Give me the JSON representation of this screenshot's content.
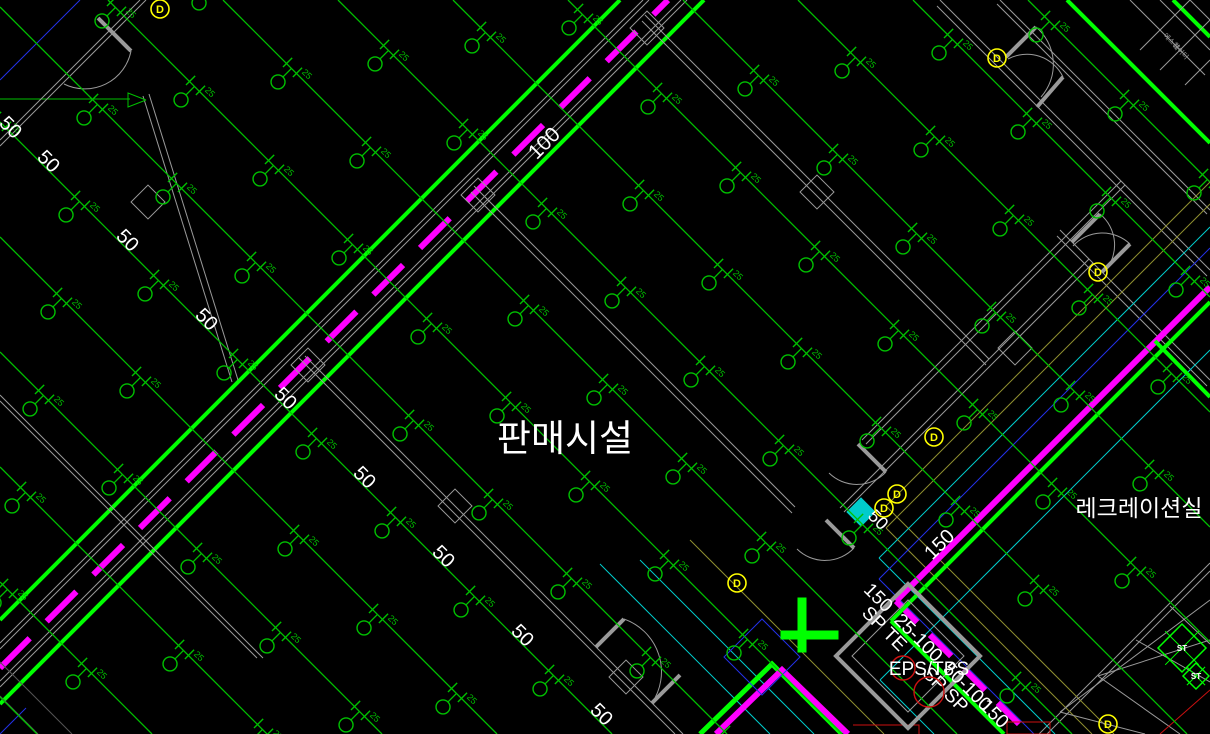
{
  "title_labels": {
    "sales_facility": "판매시설",
    "recreation_room": "레크레이션실",
    "shaft": "EPS/TPS"
  },
  "labels": {
    "head_size": "25",
    "d_marker": "D",
    "st": "ST",
    "stair_text_1": "에스컬",
    "stair_text_2": "레이터"
  },
  "colors": {
    "green": "#00C000",
    "bright": "#00FF00",
    "magenta": "#FF00FF",
    "gray": "#9A9A9A",
    "dimgray": "#555555",
    "blue": "#2332E8",
    "cyan": "#00CCCC",
    "olive": "#8F8F30",
    "yellow": "#FFFF00",
    "red": "#CC1111",
    "white": "#FFFFFF"
  },
  "pipe_labels": [
    {
      "t": "100",
      "x": 549,
      "y": 148,
      "r": -45,
      "s": 21
    },
    {
      "t": "50",
      "x": 6,
      "y": 132,
      "r": 45,
      "s": 20
    },
    {
      "t": "50",
      "x": 44,
      "y": 166,
      "r": 45,
      "s": 20
    },
    {
      "t": "50",
      "x": 123,
      "y": 245,
      "r": 45,
      "s": 20
    },
    {
      "t": "50",
      "x": 202,
      "y": 324,
      "r": 45,
      "s": 20
    },
    {
      "t": "50",
      "x": 281,
      "y": 403,
      "r": 45,
      "s": 20
    },
    {
      "t": "50",
      "x": 360,
      "y": 482,
      "r": 45,
      "s": 20
    },
    {
      "t": "50",
      "x": 439,
      "y": 561,
      "r": 45,
      "s": 20
    },
    {
      "t": "50",
      "x": 518,
      "y": 640,
      "r": 45,
      "s": 20
    },
    {
      "t": "50",
      "x": 597,
      "y": 719,
      "r": 45,
      "s": 20
    },
    {
      "t": "50",
      "x": 874,
      "y": 524,
      "r": 45,
      "s": 18
    },
    {
      "t": "150",
      "x": 944,
      "y": 549,
      "r": -45,
      "s": 20
    },
    {
      "t": "150",
      "x": 874,
      "y": 602,
      "r": 45,
      "s": 19
    },
    {
      "t": "25-100",
      "x": 914,
      "y": 642,
      "r": 45,
      "s": 19
    },
    {
      "t": "SP TE",
      "x": 880,
      "y": 633,
      "r": 45,
      "s": 19
    },
    {
      "t": "SP SP",
      "x": 941,
      "y": 694,
      "r": 45,
      "s": 19
    },
    {
      "t": "50-100",
      "x": 963,
      "y": 691,
      "r": 45,
      "s": 19
    },
    {
      "t": "150",
      "x": 990,
      "y": 718,
      "r": 45,
      "s": 19
    }
  ],
  "drawing": {
    "branches": {
      "c_values": [
        -1028,
        -913,
        -798,
        -683,
        -568,
        -453,
        -338,
        -223,
        -108,
        7,
        122,
        237,
        352,
        467,
        582,
        697
      ],
      "s0": 130,
      "stagger": 79,
      "s_step": 158
    },
    "segments": [
      [
        0,
        620,
        620,
        0,
        "bright",
        4,
        null
      ],
      [
        0,
        643,
        643,
        0,
        "gray",
        1,
        null
      ],
      [
        0,
        649,
        649,
        0,
        "gray",
        1,
        null
      ],
      [
        0,
        668,
        668,
        0,
        "magenta",
        6,
        "42 24"
      ],
      [
        0,
        681,
        681,
        0,
        "gray",
        1,
        null
      ],
      [
        0,
        687,
        687,
        0,
        "gray",
        1,
        null
      ],
      [
        0,
        704,
        704,
        0,
        "bright",
        4,
        null
      ],
      [
        0,
        99,
        130,
        99,
        "green",
        1,
        null
      ],
      [
        80,
        0,
        0,
        80,
        "blue",
        1,
        null
      ],
      [
        26,
        708,
        0,
        734,
        "blue",
        1,
        null
      ],
      [
        0,
        662,
        72,
        734,
        "dimgray",
        1,
        null
      ],
      [
        0,
        696,
        38,
        734,
        "dimgray",
        1,
        null
      ],
      [
        143,
        96,
        232,
        382,
        "gray",
        1,
        null
      ],
      [
        149,
        94,
        238,
        380,
        "gray",
        1,
        null
      ],
      [
        140,
        0,
        0,
        140,
        "gray",
        1,
        null
      ],
      [
        146,
        0,
        0,
        146,
        "gray",
        1,
        null
      ],
      [
        0,
        395,
        263,
        658,
        "gray",
        1,
        null
      ],
      [
        0,
        401,
        257,
        658,
        "gray",
        1,
        null
      ],
      [
        305,
        356,
        683,
        734,
        "gray",
        1,
        null
      ],
      [
        299,
        358,
        675,
        734,
        "gray",
        1,
        null
      ],
      [
        645,
        15,
        989,
        359,
        "gray",
        1,
        null
      ],
      [
        642,
        21,
        986,
        365,
        "gray",
        1,
        null
      ],
      [
        474,
        186,
        795,
        507,
        "gray",
        1,
        null
      ],
      [
        471,
        192,
        792,
        513,
        "gray",
        1,
        null
      ],
      [
        940,
        0,
        1210,
        270,
        "gray",
        1,
        null
      ],
      [
        937,
        6,
        1207,
        276,
        "gray",
        1,
        null
      ],
      [
        1060,
        230,
        1210,
        380,
        "gray",
        1,
        null
      ],
      [
        1057,
        236,
        1207,
        386,
        "gray",
        1,
        null
      ],
      [
        1121,
        181,
        862,
        440,
        "gray",
        1,
        null
      ],
      [
        1125,
        185,
        866,
        444,
        "gray",
        1,
        null
      ],
      [
        1089,
        259,
        840,
        508,
        "gray",
        1,
        null
      ],
      [
        1093,
        263,
        844,
        512,
        "gray",
        1,
        null
      ],
      [
        1210,
        563,
        1039,
        734,
        "gray",
        1,
        null
      ],
      [
        1210,
        571,
        1047,
        734,
        "gray",
        1,
        null
      ],
      [
        1067,
        0,
        1210,
        143,
        "bright",
        4,
        null
      ],
      [
        1173,
        0,
        1210,
        37,
        "bright",
        4,
        null
      ],
      [
        1000,
        0,
        1210,
        210,
        "gray",
        1,
        null
      ],
      [
        997,
        4,
        1207,
        214,
        "gray",
        1,
        null
      ],
      [
        1130,
        0,
        1205,
        75,
        "gray",
        1,
        null
      ],
      [
        1160,
        0,
        1210,
        50,
        "gray",
        1,
        null
      ],
      [
        1190,
        0,
        1210,
        20,
        "gray",
        1,
        null
      ],
      [
        1190,
        0,
        1140,
        50,
        "gray",
        1,
        null
      ],
      [
        1210,
        20,
        1160,
        70,
        "gray",
        1,
        null
      ],
      [
        1210,
        60,
        1185,
        85,
        "gray",
        1,
        null
      ],
      [
        1210,
        182,
        886,
        506,
        "olive",
        1,
        null
      ],
      [
        886,
        506,
        1114,
        734,
        "olive",
        1,
        null
      ],
      [
        1210,
        204,
        886,
        528,
        "olive",
        1,
        null
      ],
      [
        886,
        528,
        1092,
        734,
        "olive",
        1,
        null
      ],
      [
        1210,
        227,
        879,
        558,
        "cyan",
        1,
        null
      ],
      [
        879,
        558,
        1055,
        734,
        "cyan",
        1,
        null
      ],
      [
        1210,
        248,
        879,
        579,
        "blue",
        1,
        null
      ],
      [
        879,
        579,
        1034,
        734,
        "blue",
        1,
        null
      ],
      [
        1210,
        350,
        880,
        680,
        "cyan",
        1,
        null
      ],
      [
        880,
        680,
        934,
        734,
        "cyan",
        1,
        null
      ],
      [
        1210,
        287,
        896,
        601,
        "magenta",
        6,
        null
      ],
      [
        896,
        601,
        1029,
        734,
        "magenta",
        6,
        "30 18"
      ],
      [
        1210,
        302,
        891,
        621,
        "bright",
        4,
        null
      ],
      [
        891,
        621,
        1004,
        734,
        "bright",
        4,
        null
      ],
      [
        1155,
        341,
        1210,
        397,
        "bright",
        4,
        null
      ],
      [
        640,
        560,
        814,
        734,
        "cyan",
        1,
        null
      ],
      [
        600,
        564,
        770,
        734,
        "cyan",
        1,
        null
      ],
      [
        690,
        540,
        884,
        734,
        "olive",
        1,
        null
      ],
      [
        1060,
        712,
        1210,
        600,
        "gray",
        1,
        null
      ],
      [
        1060,
        712,
        1145,
        734,
        "gray",
        1,
        null
      ],
      [
        1098,
        676,
        1210,
        640,
        "gray",
        1,
        null
      ],
      [
        1098,
        676,
        1180,
        734,
        "gray",
        1,
        null
      ],
      [
        1136,
        640,
        1210,
        682,
        "gray",
        1,
        null
      ],
      [
        1170,
        606,
        1210,
        644,
        "gray",
        1,
        null
      ],
      [
        1210,
        690,
        1160,
        734,
        "red",
        1,
        null
      ],
      [
        98,
        18,
        131,
        51,
        "gray",
        4,
        null
      ],
      [
        1006,
        57,
        1036,
        27,
        "gray",
        4,
        null
      ],
      [
        1037,
        107,
        1063,
        77,
        "gray",
        4,
        null
      ],
      [
        1072,
        242,
        1100,
        214,
        "gray",
        4,
        null
      ],
      [
        1102,
        272,
        1130,
        244,
        "gray",
        4,
        null
      ],
      [
        858,
        444,
        886,
        472,
        "gray",
        4,
        null
      ],
      [
        826,
        520,
        854,
        548,
        "gray",
        4,
        null
      ],
      [
        596,
        647,
        624,
        619,
        "gray",
        4,
        null
      ],
      [
        652,
        703,
        680,
        675,
        "gray",
        4,
        null
      ]
    ],
    "polylines": [
      {
        "pts": "700,734 772,664 842,734",
        "c": "bright",
        "w": 5
      },
      {
        "pts": "716,734 782,670 848,734",
        "c": "magenta",
        "w": 6
      },
      {
        "pts": "853,725 919,725 919,734",
        "c": "red",
        "w": 1
      },
      {
        "pts": "1007,722 1050,722 1050,734 1007,734 1007,722",
        "c": "red",
        "w": 1
      },
      {
        "pts": "146,100 128,93 128,107 146,100",
        "c": "green",
        "w": 1
      }
    ],
    "polygons": [
      {
        "pts": "762,619 800,657 762,695 724,657",
        "c": "blue",
        "w": 1,
        "fill": false
      },
      {
        "pts": "861,498 875,512 861,526 847,512",
        "c": "cyan",
        "w": 1,
        "fill": true
      },
      {
        "pts": "908,584 980,656 908,728 836,656",
        "c": "gray",
        "w": 4,
        "fill": false
      },
      {
        "pts": "908,600 964,656 908,712 852,656",
        "c": "gray",
        "w": 1,
        "fill": false
      },
      {
        "pts": "798,598 806,598 806,652 798,652",
        "c": "bright",
        "w": 1,
        "fill": true
      },
      {
        "pts": "781,631 838,631 838,639 781,639",
        "c": "bright",
        "w": 1,
        "fill": true
      }
    ],
    "paths": [
      {
        "d": "M 131 51 A 47 47 0 0 1 64 84",
        "c": "gray",
        "w": 1
      },
      {
        "d": "M 1036 27 A 49 49 0 0 1 1041 97",
        "c": "gray",
        "w": 1
      },
      {
        "d": "M 1063 77 A 40 40 0 0 0 1008 59",
        "c": "gray",
        "w": 1
      },
      {
        "d": "M 1100 214 A 40 40 0 0 1 1104 272",
        "c": "gray",
        "w": 1
      },
      {
        "d": "M 1130 244 A 40 40 0 0 0 1073 246",
        "c": "gray",
        "w": 1
      },
      {
        "d": "M 886 472 A 40 40 0 0 1 829 473",
        "c": "gray",
        "w": 1
      },
      {
        "d": "M 854 548 A 40 40 0 0 1 797 549",
        "c": "gray",
        "w": 1
      },
      {
        "d": "M 624 619 A 56 56 0 0 1 652 703",
        "c": "gray",
        "w": 1
      }
    ],
    "columns": [
      [
        647,
        28
      ],
      [
        478,
        195
      ],
      [
        308,
        365
      ],
      [
        148,
        202
      ],
      [
        817,
        192
      ],
      [
        626,
        677
      ],
      [
        455,
        506
      ],
      [
        1015,
        348
      ]
    ],
    "d_markers": [
      [
        160,
        9
      ],
      [
        997,
        58
      ],
      [
        1098,
        272
      ],
      [
        934,
        437
      ],
      [
        897,
        494
      ],
      [
        884,
        508
      ],
      [
        737,
        583
      ],
      [
        1108,
        724
      ]
    ],
    "diamonds": [
      {
        "x": 1182,
        "y": 648,
        "r": 24
      },
      {
        "x": 1196,
        "y": 676,
        "r": 13
      }
    ],
    "stair_text": [
      {
        "key": "stair_text_1",
        "x": 1163,
        "y": 36
      },
      {
        "key": "stair_text_2",
        "x": 1172,
        "y": 46
      }
    ]
  }
}
